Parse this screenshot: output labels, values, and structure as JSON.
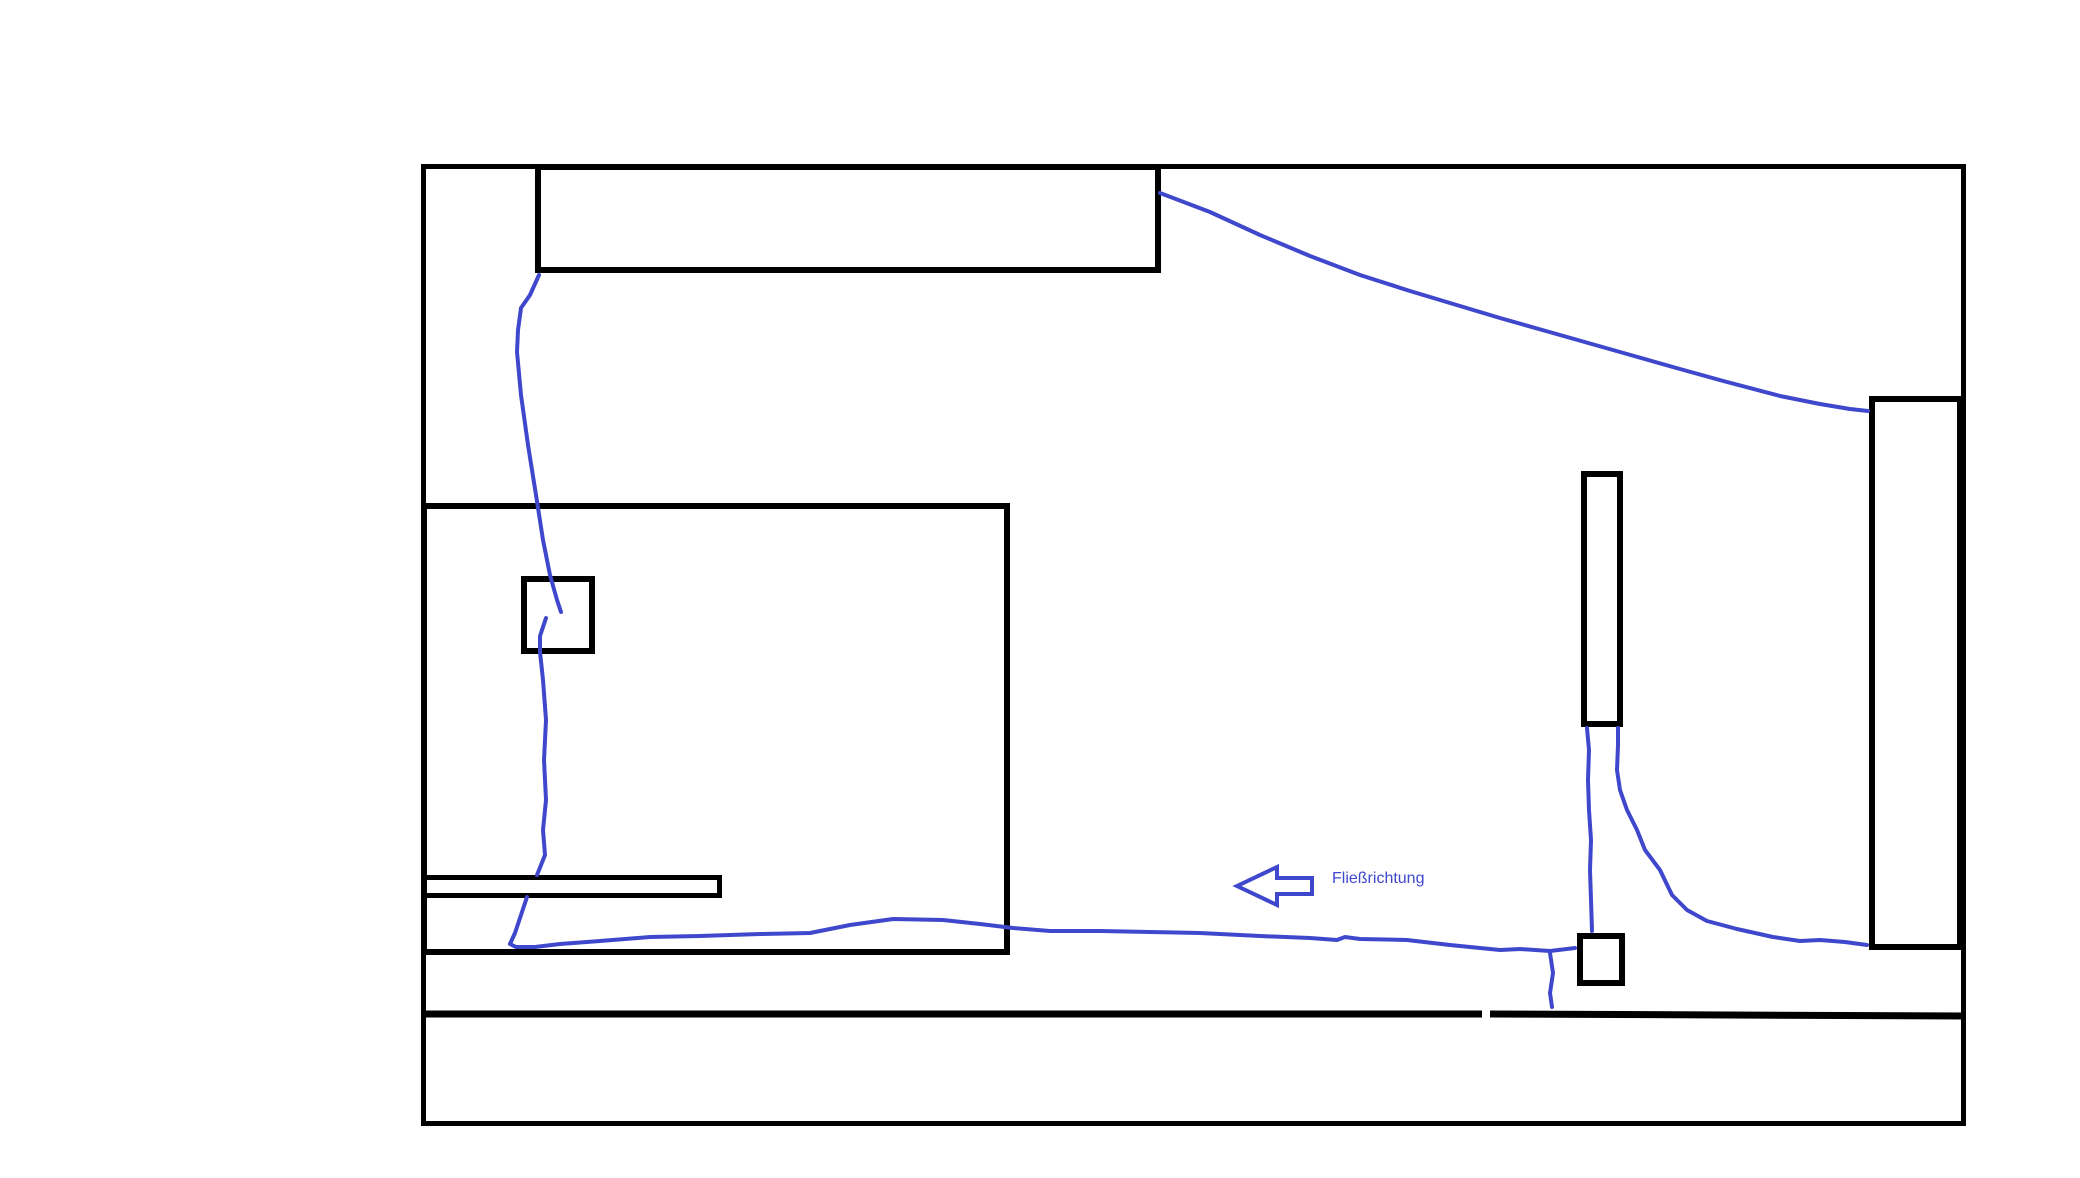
{
  "canvas": {
    "width": 2080,
    "height": 1178,
    "background": "#FFFFFF"
  },
  "palette": {
    "outline": "#000000",
    "flow": "#3F48CC",
    "fill": "#FFFFFF"
  },
  "label": {
    "text": "Fließrichtung"
  },
  "shapes": {
    "rectangles": [
      {
        "name": "outer-boundary",
        "x": 421,
        "y": 164,
        "w": 1545,
        "h": 962,
        "stroke": 5
      },
      {
        "name": "top-structure",
        "x": 535,
        "y": 164,
        "w": 626,
        "h": 109,
        "stroke": 6
      },
      {
        "name": "left-structure",
        "x": 421,
        "y": 503,
        "w": 589,
        "h": 452,
        "stroke": 6
      },
      {
        "name": "left-inner-square",
        "x": 521,
        "y": 576,
        "w": 74,
        "h": 78,
        "stroke": 6
      },
      {
        "name": "left-shelf-bar",
        "x": 421,
        "y": 875,
        "w": 301,
        "h": 23,
        "stroke": 5
      },
      {
        "name": "middle-column",
        "x": 1581,
        "y": 471,
        "w": 42,
        "h": 256,
        "stroke": 6
      },
      {
        "name": "middle-small-square",
        "x": 1577,
        "y": 933,
        "w": 48,
        "h": 53,
        "stroke": 6
      },
      {
        "name": "right-structure",
        "x": 1869,
        "y": 396,
        "w": 94,
        "h": 554,
        "stroke": 6
      }
    ],
    "segments": [
      {
        "name": "lower-divider-left",
        "x1": 421,
        "y1": 1014,
        "x2": 1482,
        "y2": 1014,
        "stroke": 7
      },
      {
        "name": "lower-divider-right",
        "x1": 1490,
        "y1": 1014,
        "x2": 1966,
        "y2": 1016,
        "stroke": 7
      }
    ],
    "flow_lines": [
      {
        "name": "flow-top-left-descent",
        "points": [
          [
            539,
            275
          ],
          [
            530,
            295
          ],
          [
            521,
            308
          ],
          [
            518,
            330
          ],
          [
            517,
            352
          ],
          [
            521,
            395
          ],
          [
            528,
            445
          ],
          [
            536,
            495
          ],
          [
            543,
            540
          ],
          [
            550,
            575
          ],
          [
            557,
            600
          ],
          [
            561,
            612
          ]
        ]
      },
      {
        "name": "flow-square-stub",
        "points": [
          [
            546,
            618
          ],
          [
            540,
            636
          ],
          [
            540,
            652
          ],
          [
            543,
            680
          ],
          [
            546,
            720
          ],
          [
            544,
            760
          ],
          [
            546,
            800
          ],
          [
            543,
            830
          ],
          [
            545,
            855
          ],
          [
            537,
            875
          ]
        ]
      },
      {
        "name": "flow-main-channel",
        "points": [
          [
            527,
            897
          ],
          [
            522,
            912
          ],
          [
            515,
            933
          ],
          [
            510,
            944
          ],
          [
            516,
            947
          ],
          [
            535,
            947
          ],
          [
            560,
            944
          ],
          [
            600,
            941
          ],
          [
            650,
            937
          ],
          [
            700,
            936
          ],
          [
            760,
            934
          ],
          [
            810,
            933
          ],
          [
            850,
            925
          ],
          [
            893,
            919
          ],
          [
            943,
            920
          ],
          [
            980,
            924
          ],
          [
            1013,
            928
          ],
          [
            1050,
            931
          ],
          [
            1100,
            931
          ],
          [
            1150,
            932
          ],
          [
            1200,
            933
          ],
          [
            1260,
            936
          ],
          [
            1310,
            938
          ],
          [
            1337,
            940
          ],
          [
            1345,
            937
          ],
          [
            1360,
            939
          ],
          [
            1407,
            940
          ],
          [
            1450,
            945
          ],
          [
            1500,
            950
          ],
          [
            1520,
            949
          ],
          [
            1550,
            951
          ],
          [
            1575,
            948
          ]
        ]
      },
      {
        "name": "flow-branch-down",
        "points": [
          [
            1550,
            953
          ],
          [
            1553,
            973
          ],
          [
            1550,
            993
          ],
          [
            1552,
            1007
          ]
        ]
      },
      {
        "name": "flow-top-diagonal",
        "points": [
          [
            1160,
            193
          ],
          [
            1210,
            212
          ],
          [
            1260,
            235
          ],
          [
            1310,
            256
          ],
          [
            1360,
            275
          ],
          [
            1410,
            291
          ],
          [
            1450,
            303
          ],
          [
            1500,
            318
          ],
          [
            1560,
            335
          ],
          [
            1620,
            352
          ],
          [
            1680,
            369
          ],
          [
            1727,
            382
          ],
          [
            1780,
            396
          ],
          [
            1820,
            404
          ],
          [
            1850,
            409
          ],
          [
            1868,
            411
          ]
        ]
      },
      {
        "name": "flow-column-to-square",
        "points": [
          [
            1587,
            728
          ],
          [
            1589,
            750
          ],
          [
            1588,
            780
          ],
          [
            1589,
            810
          ],
          [
            1591,
            840
          ],
          [
            1590,
            870
          ],
          [
            1591,
            900
          ],
          [
            1592,
            931
          ]
        ]
      },
      {
        "name": "flow-column-sweep-right",
        "points": [
          [
            1618,
            728
          ],
          [
            1618,
            745
          ],
          [
            1617,
            770
          ],
          [
            1620,
            790
          ],
          [
            1627,
            810
          ],
          [
            1637,
            830
          ],
          [
            1645,
            850
          ],
          [
            1660,
            870
          ],
          [
            1672,
            895
          ],
          [
            1687,
            910
          ],
          [
            1707,
            921
          ],
          [
            1737,
            929
          ],
          [
            1773,
            937
          ],
          [
            1800,
            941
          ],
          [
            1820,
            940
          ],
          [
            1845,
            942
          ],
          [
            1867,
            945
          ]
        ]
      }
    ],
    "arrow": {
      "name": "flow-direction-arrow",
      "stroke": 4,
      "points": [
        [
          1237,
          886
        ],
        [
          1277,
          867
        ],
        [
          1277,
          878
        ],
        [
          1312,
          878
        ],
        [
          1312,
          894
        ],
        [
          1277,
          894
        ],
        [
          1277,
          905
        ]
      ]
    }
  }
}
